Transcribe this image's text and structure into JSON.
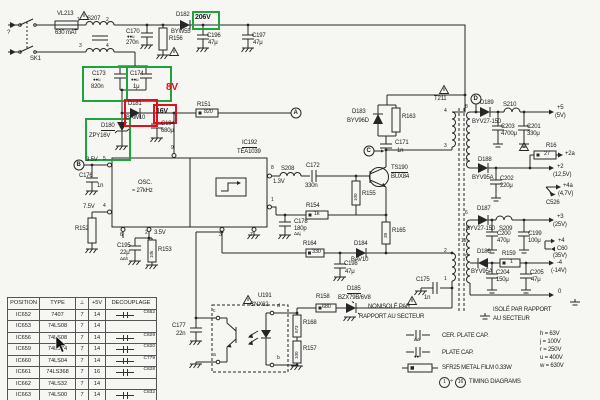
{
  "annotations": {
    "v206": "206V",
    "v8": "8V",
    "v16": "16V"
  },
  "mains": {
    "sk1": "SK1",
    "plug": "?",
    "fuse_ref": "VL213",
    "fuse_value": "630 mAT",
    "filter_ref": "S207",
    "pin1": "1",
    "pin2": "2",
    "pin3": "3",
    "pin4": "4",
    "c170_ref": "C170",
    "c170_mark": "●●u",
    "c170_value": "270n",
    "r156_ref": "R156",
    "d182_ref": "D182",
    "d182_type": "BYW55",
    "c196_ref": "C196",
    "c196_value": "47μ",
    "c197_ref": "C197",
    "c197_value": "47μ"
  },
  "startup": {
    "c173_ref": "C173",
    "c173_mark": "●●u",
    "c173_value": "820n",
    "c174_ref": "C174",
    "c174_mark": "●●u",
    "c174_value": "1μ",
    "d181_ref": "D181",
    "d181_type": "BAW10",
    "d180_ref": "D180",
    "d180_type": "ZPY16V",
    "c194_ref": "C194",
    "c194_value": "680μ",
    "r151_ref": "R151",
    "r151_value": "820"
  },
  "ic": {
    "ref": "IC192",
    "type": "TEA1039",
    "osc_label": "OSC.",
    "osc_freq": "≈ 27kHz",
    "pin9": "9",
    "pin5": "5",
    "pin4": "4",
    "pin6": "6",
    "pin2": "2",
    "pin3": "3",
    "pin7": "7",
    "pin8": "8",
    "pin1": "1",
    "v_pin5": "3.5V",
    "v_pin4": "7.5V",
    "v_pin2": "3.5V",
    "v_pin8": "1.3V",
    "node_b": "B",
    "c176_ref": "C176",
    "c176_value": "1n",
    "r152_ref": "R152",
    "c195_ref": "C195",
    "c195_value": "22μ",
    "c195_note": "ΔΔh",
    "r153_ref": "R153",
    "r153_value": "10k"
  },
  "driver": {
    "node_a": "A",
    "node_c": "C",
    "s208": "S208",
    "c172_ref": "C172",
    "c172_value": "330n",
    "r154_ref": "R154",
    "r154_value": "1k",
    "r155_ref": "R155",
    "r155_value": "100",
    "q_ref": "TS190",
    "q_type": "BUX84",
    "c171_ref": "C171",
    "c171_value": "1n",
    "d183_ref": "D183",
    "d183_type": "BYV96D",
    "r163_ref": "R163",
    "r165_ref": "R165",
    "r165_value": "39"
  },
  "transformer": {
    "ref": "T211",
    "node_d": "D",
    "p4": "4",
    "p3": "3",
    "p2": "2",
    "p1": "1",
    "s8": "8",
    "s7": "7",
    "s6": "6",
    "s15": "15",
    "s9": "9"
  },
  "outputs": {
    "rail5": {
      "d_ref": "D189",
      "d_type": "BYV27-150",
      "l_ref": "S210",
      "c1_ref": "C203",
      "c1_value": "4700μ",
      "c2_ref": "C201",
      "c2_value": "330μ",
      "out": "+5",
      "out_v": "(5V)"
    },
    "rail2": {
      "d_ref": "D188",
      "d_type": "BYV95A",
      "c_ref": "C202",
      "c_value": "220μ",
      "r_ref": "R16",
      "r_value": "27",
      "out_a": "+2a",
      "out": "+2",
      "out_v": "(12,5V)",
      "out4a": "+4a",
      "out4a_v": "(4,7V)",
      "out4a_cap": "C526"
    },
    "rail3": {
      "d_ref": "D187",
      "d_type": "BYV27-150",
      "l_ref": "S209",
      "c1_ref": "C200",
      "c1_value": "470μ",
      "c2_ref": "C199",
      "c2_value": "100μ",
      "out": "+3",
      "out_v": "(25V)"
    },
    "rail4": {
      "d_ref": "D186",
      "d_type": "BYV95A",
      "r_ref": "R159",
      "r_value": "1",
      "c1_ref": "C204",
      "c1_value": "150μ",
      "c2_ref": "C205",
      "c2_value": "47μ",
      "out_p4": "+4",
      "out_p4_cap": "C60",
      "out_p4_v": "(35V)",
      "out": "-4",
      "out_v": "(-14V)",
      "out0": "0"
    },
    "c175_ref": "C175",
    "c175_value": "1n"
  },
  "feedback": {
    "r164_ref": "R164",
    "r164_value": "330",
    "c178_ref": "C178",
    "c178_value": "180p",
    "c178_note": "ΔΔj",
    "d184_ref": "D184",
    "d184_type": "BAV10",
    "c198_ref": "C198",
    "c198_value": "47μ",
    "d185_ref": "D185",
    "d185_type": "BZX79B/6V8",
    "r158_ref": "R158",
    "r158_value": "680",
    "opto_ref": "U191",
    "opto_type": "CNX62",
    "pin_c": "c",
    "pin_a": "a",
    "pin_d": "d",
    "pin_b": "b",
    "c177_ref": "C177",
    "c177_value": "22n",
    "r168_ref": "R168",
    "r168_value": "673",
    "r157_ref": "R157",
    "r157_value": "100"
  },
  "grounds": {
    "noniso_1": "NONISOLÉ PAR",
    "noniso_2": "RAPPORT AU SECTEUR",
    "iso_1": "ISOLÉ PAR RAPPORT",
    "iso_2": "AU SECTEUR"
  },
  "table": {
    "headers": {
      "position": "POSITION",
      "type": "TYPE",
      "gnd": "⊥",
      "v5": "+5V",
      "decouplage": "DECOUPLAGE"
    },
    "rows": [
      {
        "position": "IC652",
        "type": "7407",
        "gnd": "7",
        "v5": "14",
        "decap": "C652"
      },
      {
        "position": "IC653",
        "type": "74LS08",
        "gnd": "7",
        "v5": "14",
        "decap": ""
      },
      {
        "position": "IC656",
        "type": "74LS08",
        "gnd": "7",
        "v5": "14",
        "decap": "C829"
      },
      {
        "position": "IC659",
        "type": "74LS74",
        "gnd": "7",
        "v5": "14",
        "decap": "C820"
      },
      {
        "position": "IC660",
        "type": "74LS04",
        "gnd": "7",
        "v5": "14",
        "decap": "C779"
      },
      {
        "position": "IC661",
        "type": "74LS368",
        "gnd": "7",
        "v5": "16",
        "decap": "C828"
      },
      {
        "position": "IC662",
        "type": "74LS32",
        "gnd": "7",
        "v5": "14",
        "decap": ""
      },
      {
        "position": "IC663",
        "type": "74LS00",
        "gnd": "7",
        "v5": "14",
        "decap": "C832"
      }
    ]
  },
  "legend": {
    "cer_cap": "CER. PLATE CAP.",
    "cer_mark": "ΔΔ",
    "plate_cap": "PLATE CAP.",
    "plate_mark": "●●",
    "resistor": "SFR25  METAL  FILM  0.33W",
    "code_h": "h = 63V",
    "code_j": "j = 100V",
    "code_r": "r = 250V",
    "code_u": "u = 400V",
    "code_w": "w = 630V",
    "timing_from": "1",
    "timing_div": "÷",
    "timing_to": "16",
    "timing_label": "TIMING DIAGRAMS"
  }
}
